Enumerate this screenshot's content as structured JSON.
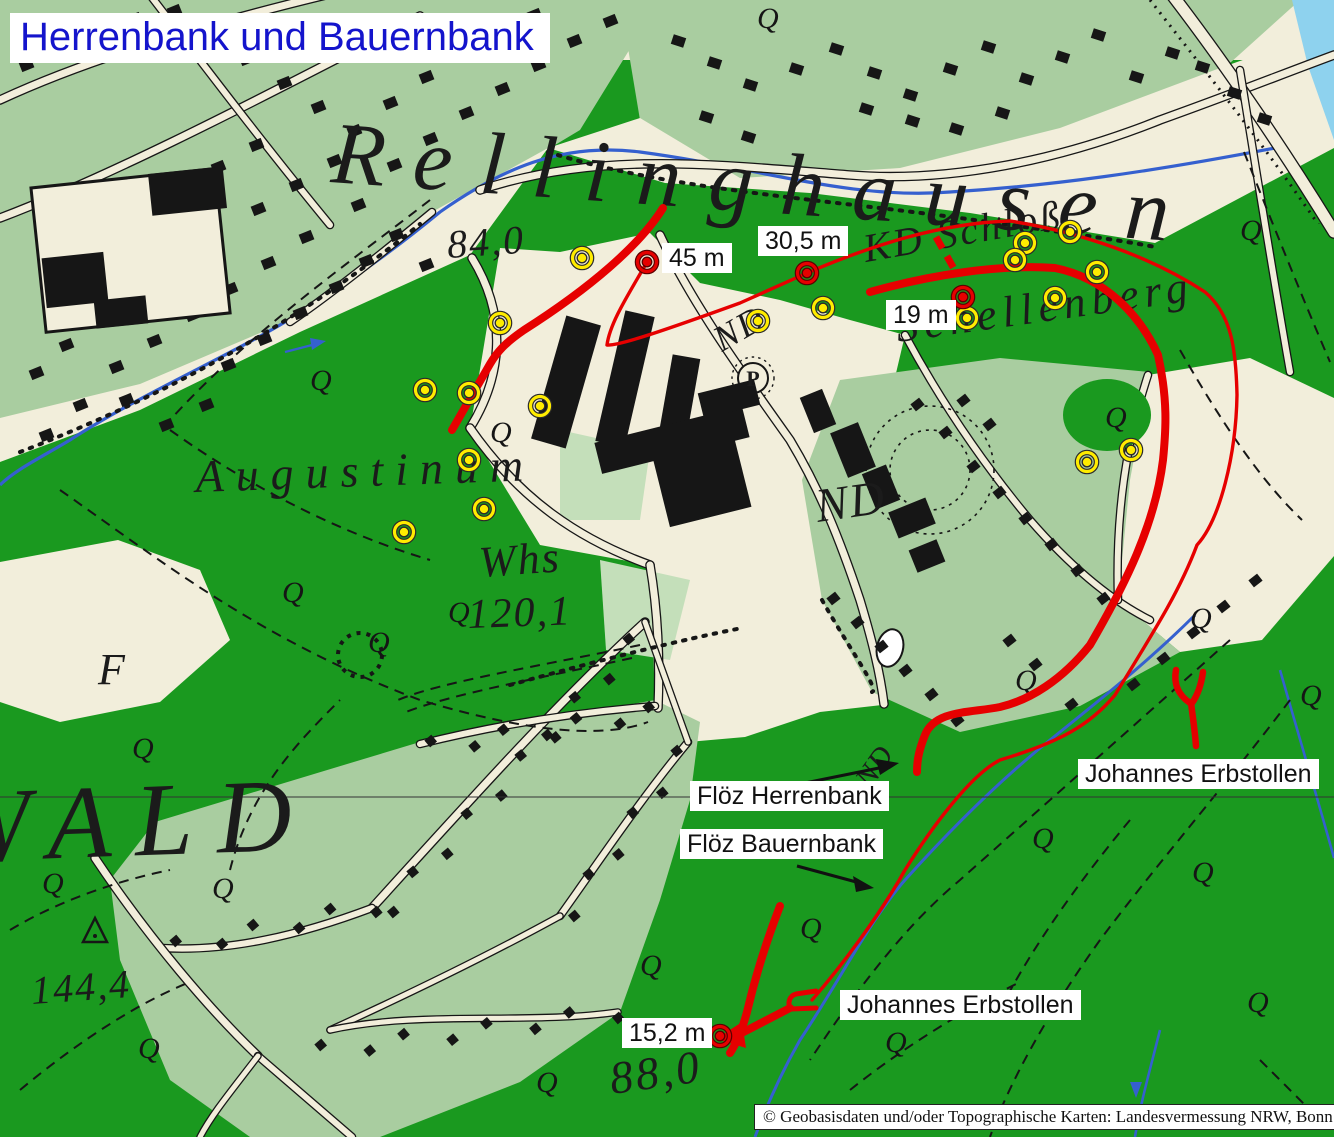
{
  "title": {
    "text": "Herrenbank und Bauernbank"
  },
  "copyright": {
    "text": "© Geobasisdaten und/oder Topographische Karten: Landesvermessung NRW, Bonn"
  },
  "annotations": {
    "measurements": [
      {
        "id": "m45",
        "text": "45 m",
        "marker": {
          "x": 647,
          "y": 262
        }
      },
      {
        "id": "m305",
        "text": "30,5 m",
        "marker": {
          "x": 807,
          "y": 273
        }
      },
      {
        "id": "m19",
        "text": "19 m",
        "marker": {
          "x": 963,
          "y": 297
        }
      },
      {
        "id": "m152",
        "text": "15,2 m",
        "marker": {
          "x": 720,
          "y": 1036
        }
      }
    ],
    "seams": [
      {
        "id": "fh",
        "text": "Flöz Herrenbank"
      },
      {
        "id": "fb",
        "text": "Flöz Bauernbank"
      }
    ],
    "adits": [
      {
        "id": "jr",
        "text": "Johannes Erbstollen"
      },
      {
        "id": "jb",
        "text": "Johannes Erbstollen"
      }
    ],
    "boreholes": [
      [
        582,
        258
      ],
      [
        500,
        323
      ],
      [
        425,
        390
      ],
      [
        469,
        393
      ],
      [
        540,
        406
      ],
      [
        469,
        460
      ],
      [
        484,
        509
      ],
      [
        404,
        532
      ],
      [
        758,
        321
      ],
      [
        823,
        308
      ],
      [
        1070,
        232
      ],
      [
        1025,
        243
      ],
      [
        1015,
        260
      ],
      [
        1097,
        272
      ],
      [
        1055,
        298
      ],
      [
        967,
        318
      ],
      [
        1131,
        450
      ],
      [
        1087,
        462
      ]
    ]
  },
  "map_labels": [
    {
      "text": "Rellinghausen",
      "x": 330,
      "y": 182,
      "size": 88,
      "rot": 4,
      "ls": 28
    },
    {
      "text": "84,0",
      "x": 448,
      "y": 258,
      "size": 40,
      "rot": -4,
      "ls": 2
    },
    {
      "text": "Augustinum",
      "x": 196,
      "y": 492,
      "size": 46,
      "rot": -2,
      "ls": 12
    },
    {
      "text": "Whs",
      "x": 480,
      "y": 577,
      "size": 44,
      "rot": -4,
      "ls": 2
    },
    {
      "text": "120,1",
      "x": 468,
      "y": 628,
      "size": 42,
      "rot": -2,
      "ls": 2
    },
    {
      "text": "ND",
      "x": 722,
      "y": 352,
      "size": 36,
      "rot": -30,
      "ls": 2
    },
    {
      "text": "ND",
      "x": 818,
      "y": 522,
      "size": 48,
      "rot": -8,
      "ls": 2
    },
    {
      "text": "ND",
      "x": 870,
      "y": 790,
      "size": 30,
      "rot": -55,
      "ls": 1
    },
    {
      "text": "KD Schloß",
      "x": 866,
      "y": 262,
      "size": 40,
      "rot": -10,
      "ls": 3
    },
    {
      "text": "Schellenberg",
      "x": 898,
      "y": 342,
      "size": 44,
      "rot": -8,
      "ls": 6
    },
    {
      "text": "WALD",
      "x": -55,
      "y": 862,
      "size": 104,
      "rot": -2,
      "ls": 24
    },
    {
      "text": "144,4",
      "x": 32,
      "y": 1004,
      "size": 40,
      "rot": -4,
      "ls": 2
    },
    {
      "text": "88,0",
      "x": 612,
      "y": 1094,
      "size": 46,
      "rot": -8,
      "ls": 3
    },
    {
      "text": "F",
      "x": 98,
      "y": 684,
      "size": 44,
      "rot": 0,
      "ls": 0
    },
    {
      "text": "P",
      "x": 753,
      "y": 386,
      "size": 22,
      "rot": 0,
      "ls": 0
    }
  ],
  "colors": {
    "forest_green": "#1a991f",
    "light_green": "#a9cda0",
    "pale_green": "#c4dfba",
    "paper_cream": "#f2eedb",
    "stream_blue": "#3560cf",
    "water_cyan": "#8ed2ee",
    "overlay_red": "#e60000",
    "marker_yellow": "#ffec00",
    "ink_black": "#161616",
    "title_blue": "#1414cc"
  }
}
